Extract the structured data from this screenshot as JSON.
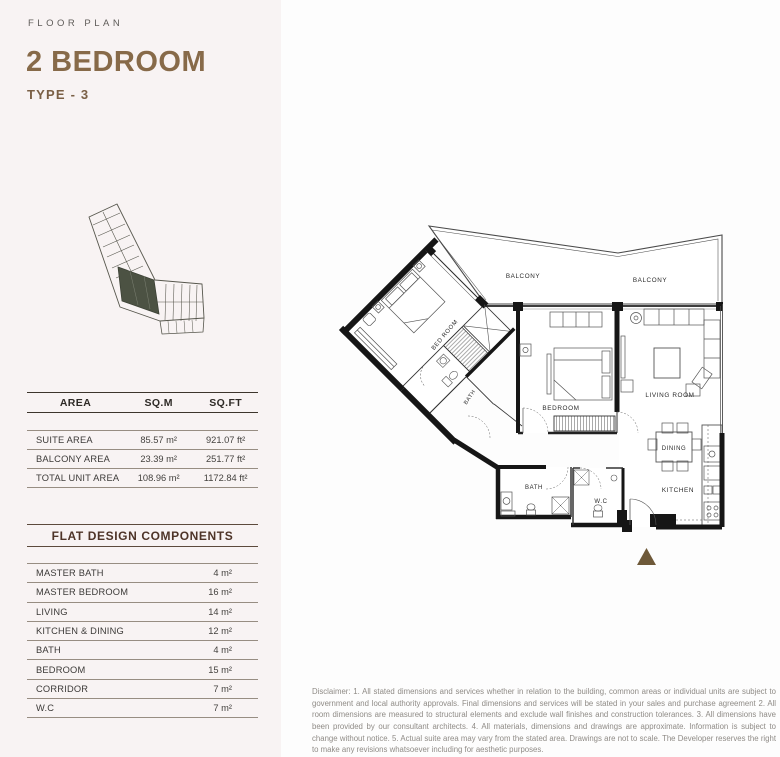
{
  "header": {
    "eyebrow": "FLOOR PLAN",
    "title": "2 BEDROOM",
    "subtitle": "TYPE - 3"
  },
  "area_table": {
    "columns": [
      "AREA",
      "SQ.M",
      "SQ.FT"
    ],
    "rows": [
      {
        "label": "SUITE AREA",
        "sqm": "85.57 m²",
        "sqft": "921.07 ft²"
      },
      {
        "label": "BALCONY AREA",
        "sqm": "23.39 m²",
        "sqft": "251.77 ft²"
      },
      {
        "label": "TOTAL UNIT AREA",
        "sqm": "108.96 m²",
        "sqft": "1172.84 ft²"
      }
    ]
  },
  "components": {
    "title": "FLAT DESIGN COMPONENTS",
    "rows": [
      {
        "label": "MASTER BATH",
        "value": "4 m²"
      },
      {
        "label": "MASTER BEDROOM",
        "value": "16 m²"
      },
      {
        "label": "LIVING",
        "value": "14 m²"
      },
      {
        "label": "KITCHEN & DINING",
        "value": "12 m²"
      },
      {
        "label": "BATH",
        "value": "4 m²"
      },
      {
        "label": "BEDROOM",
        "value": "15 m²"
      },
      {
        "label": "CORRIDOR",
        "value": "7 m²"
      },
      {
        "label": "W.C",
        "value": "7 m²"
      }
    ]
  },
  "plan": {
    "labels": {
      "balcony_left": "BALCONY",
      "balcony_right": "BALCONY",
      "master_bedroom": "BED ROOM",
      "master_bath": "BATH",
      "bedroom": "BEDROOM",
      "living": "LIVING ROOM",
      "dining": "DINING",
      "kitchen": "KITCHEN",
      "bath": "BATH",
      "wc": "W.C"
    },
    "colors": {
      "wall": "#161616",
      "thin_line": "#4a4a4a",
      "marker": "#6e5939",
      "keyplan_highlight": "#4c5243",
      "accent_brown": "#876a49"
    }
  },
  "disclaimer": "Disclaimer: 1. All stated dimensions and services whether in relation to the building, common areas or individual units are subject to government and local authority approvals. Final dimensions and services will be stated in your sales and purchase agreement 2. All room dimensions are measured to structural elements and exclude wall finishes and construction tolerances. 3. All dimensions have been provided by our consultant architects. 4. All materials, dimensions and drawings are approximate. Information is subject to change without notice. 5. Actual suite area may vary from the stated area. Drawings are not to scale. The Developer reserves the right to make any revisions whatsoever including for aesthetic purposes."
}
